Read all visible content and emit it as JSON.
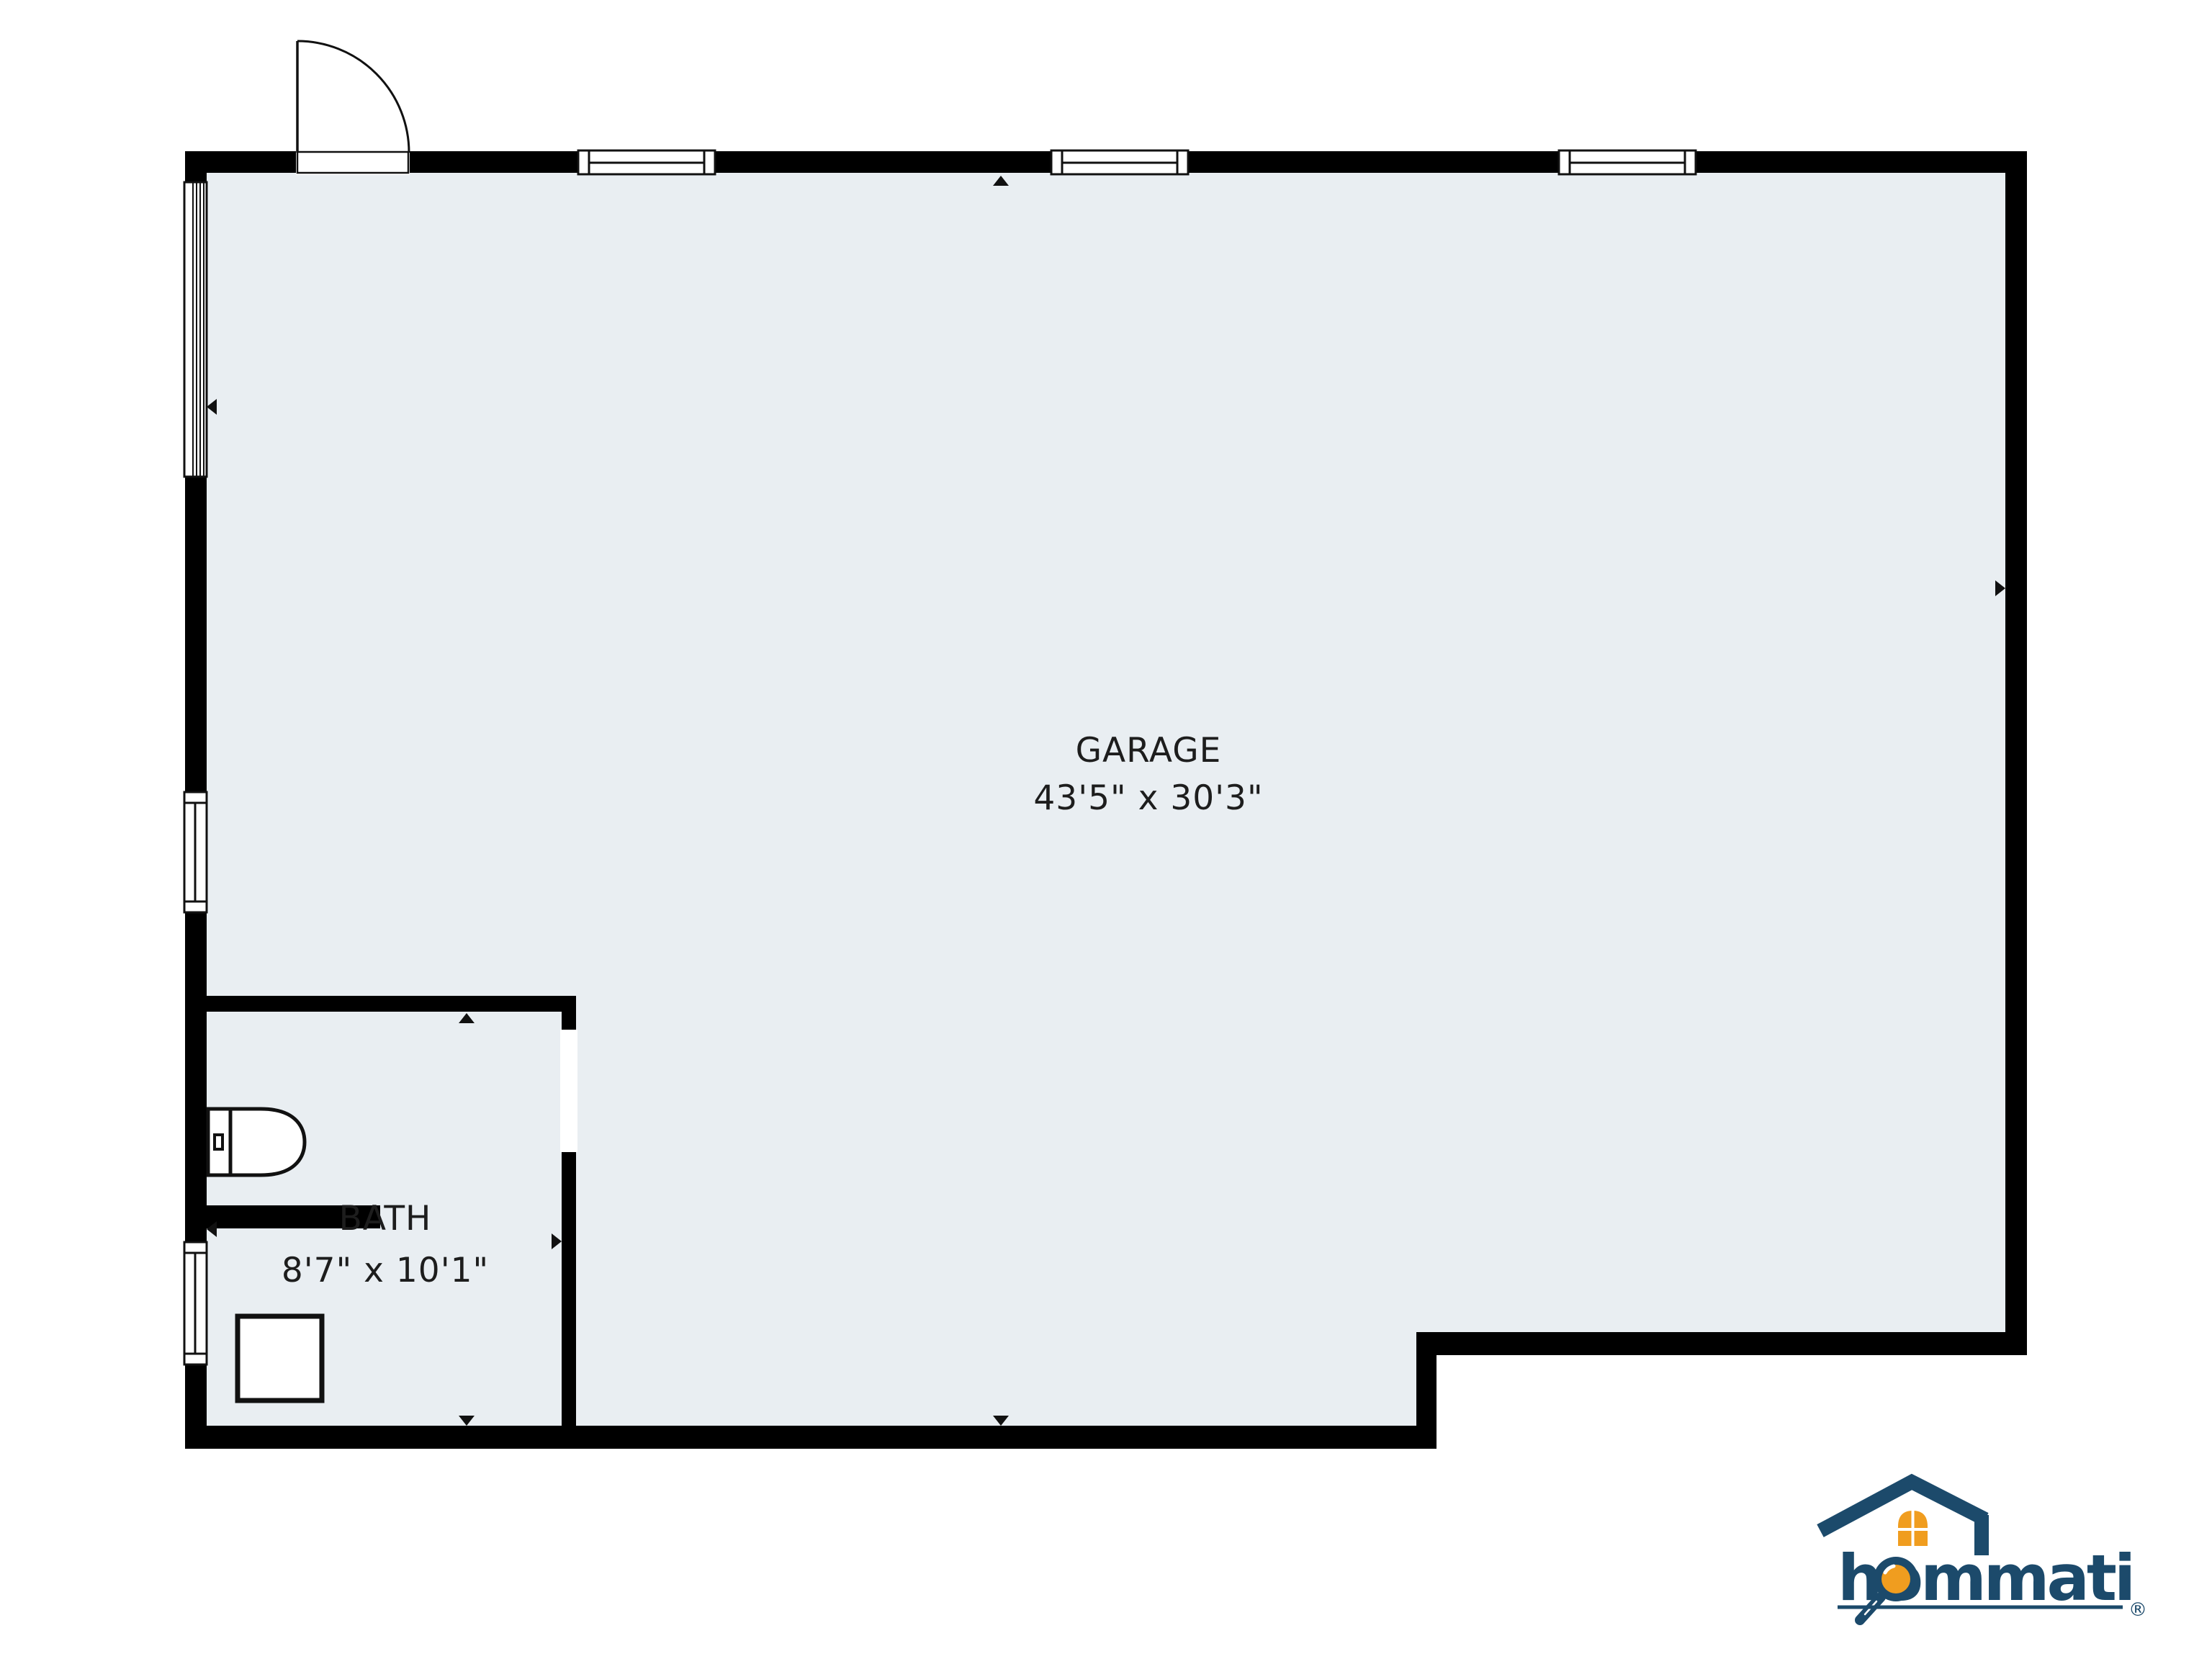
{
  "floorplan": {
    "floor_color": "#e9eef2",
    "wall_color": "#000000",
    "rooms": [
      {
        "id": "garage",
        "name": "GARAGE",
        "dimensions": "43'5\" x 30'3\""
      },
      {
        "id": "bath",
        "name": "BATH",
        "dimensions": "8'7\" x 10'1\""
      }
    ],
    "fixtures": [
      "toilet",
      "shower-base"
    ],
    "features": [
      "entry-door-swing",
      "window",
      "sliding-window",
      "door-opening"
    ]
  },
  "logo": {
    "brand": "hommati",
    "registered_mark": "®",
    "colors": {
      "navy": "#1c4a6b",
      "orange": "#f09d1f"
    }
  }
}
